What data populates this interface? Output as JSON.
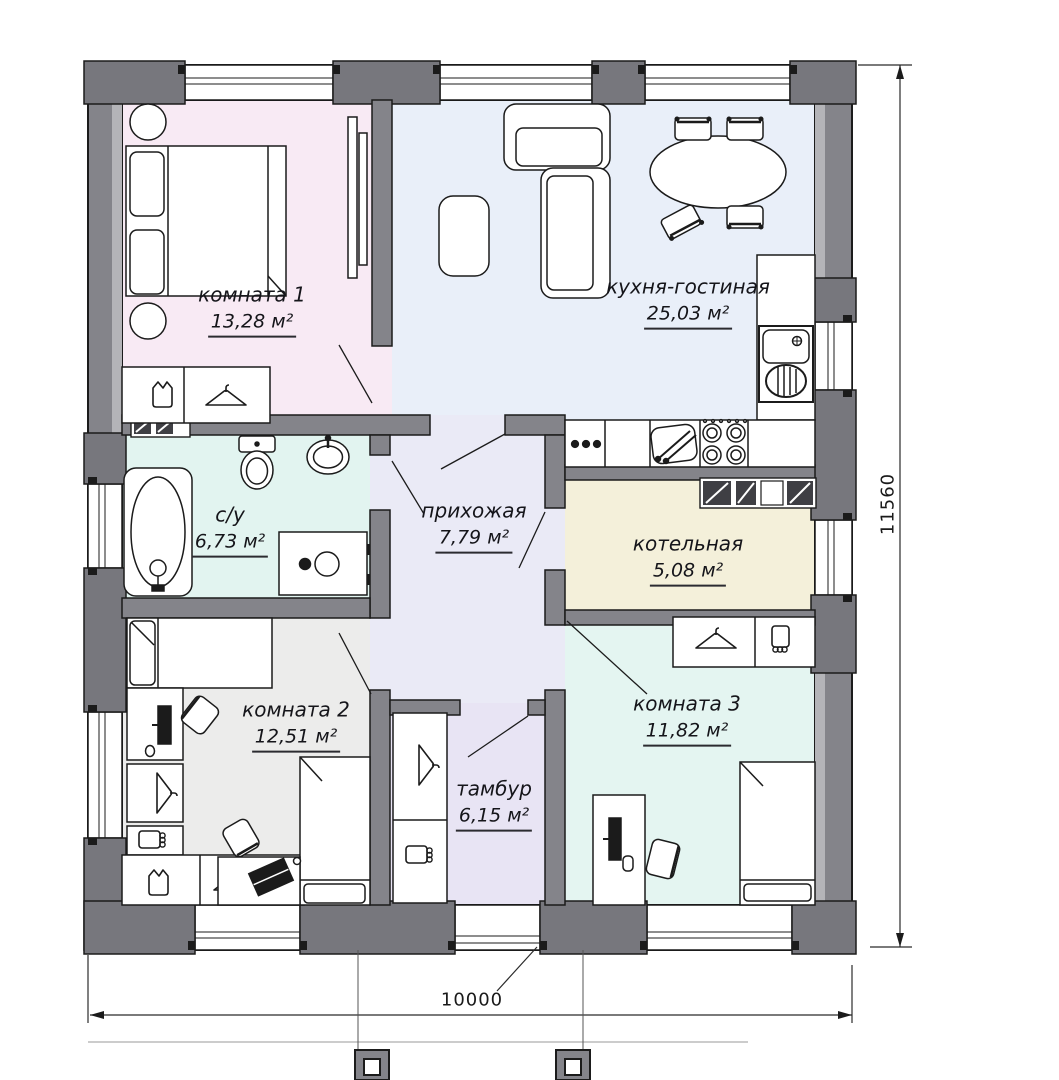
{
  "plan": {
    "type": "floor_plan",
    "rooms": [
      {
        "name": "комната 1",
        "area": "13,28 м²"
      },
      {
        "name": "кухня-гостиная",
        "area": "25,03 м²"
      },
      {
        "name": "с/у",
        "area": "6,73 м²"
      },
      {
        "name": "прихожая",
        "area": "7,79 м²"
      },
      {
        "name": "котельная",
        "area": "5,08 м²"
      },
      {
        "name": "комната 2",
        "area": "12,51 м²"
      },
      {
        "name": "тамбур",
        "area": "6,15 м²"
      },
      {
        "name": "комната 3",
        "area": "11,82 м²"
      }
    ],
    "dimensions": {
      "width_label": "10000",
      "height_label": "11560"
    },
    "colors": {
      "room1": "#f8eaf4",
      "kitchen_living": "#e9eff9",
      "bathroom": "#e2f4f0",
      "hallway": "#eaeaf6",
      "boiler": "#f4f0da",
      "room2": "#ececeb",
      "vestibule": "#e8e4f4",
      "room3": "#e4f5f1",
      "wall": "#84848a",
      "wall_pier": "#77777d",
      "wall_inner_lining": "#b4b4b8"
    }
  }
}
